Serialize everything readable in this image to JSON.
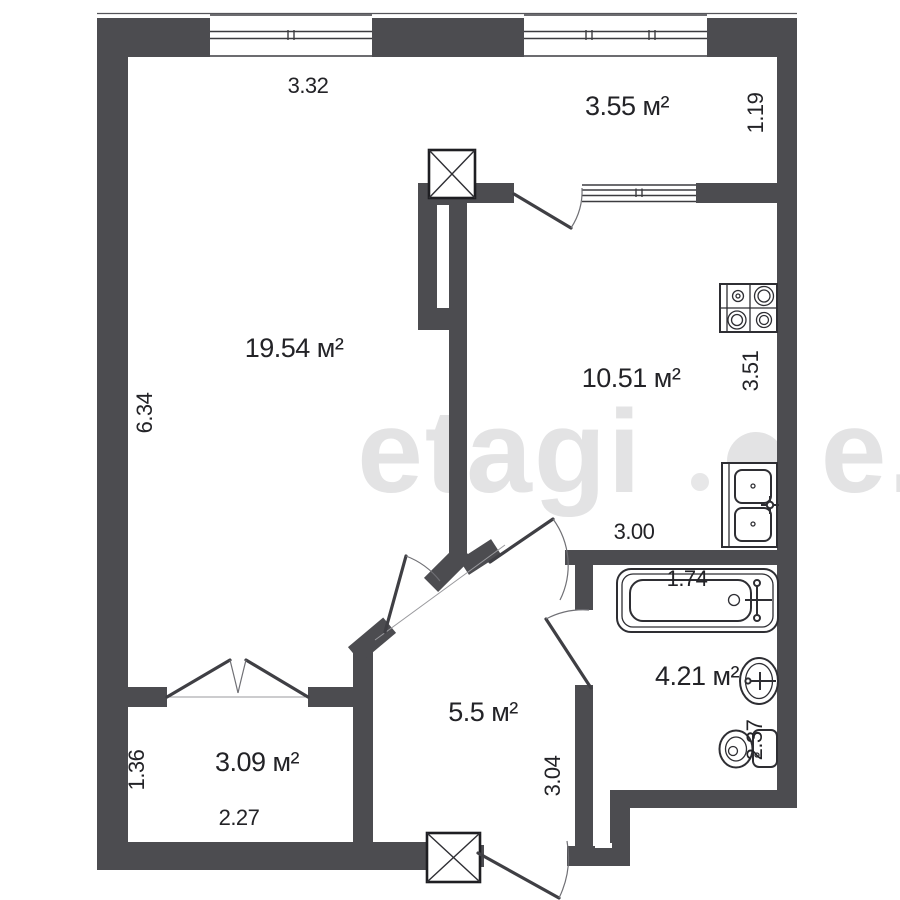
{
  "title": "one-room-apartment-floor-plan",
  "watermark": {
    "brand": "etagi",
    "suffix": "e."
  },
  "rooms": {
    "living": {
      "area": "19.54 м²"
    },
    "balcony": {
      "area": "3.55 м²"
    },
    "kitchen": {
      "area": "10.51 м²"
    },
    "hallway": {
      "area": "5.5 м²"
    },
    "bathroom": {
      "area": "4.21 м²"
    },
    "storage": {
      "area": "3.09 м²"
    }
  },
  "dimensions": {
    "living_width": "3.32",
    "living_depth": "6.34",
    "balcony_depth": "1.19",
    "kitchen_depth": "3.51",
    "kitchen_width": "3.00",
    "bathtub_width": "1.74",
    "bathroom_depth": "2.37",
    "hallway_depth": "3.04",
    "storage_width": "2.27",
    "storage_depth": "1.36"
  },
  "icons": {
    "stove": "stove-icon",
    "kitchen_sink": "kitchen-sink-icon",
    "bathtub": "bathtub-icon",
    "washbasin": "washbasin-icon",
    "toilet": "toilet-icon",
    "vent_shaft_top": "vent-shaft-icon",
    "vent_shaft_entrance": "vent-shaft-icon",
    "doors": "door-swing-icon",
    "windows": "window-icon"
  },
  "colors": {
    "wall": "#4c4c50",
    "line": "#2e2e33",
    "text": "#232327",
    "watermark": "#e3e3e4",
    "background": "#ffffff"
  }
}
